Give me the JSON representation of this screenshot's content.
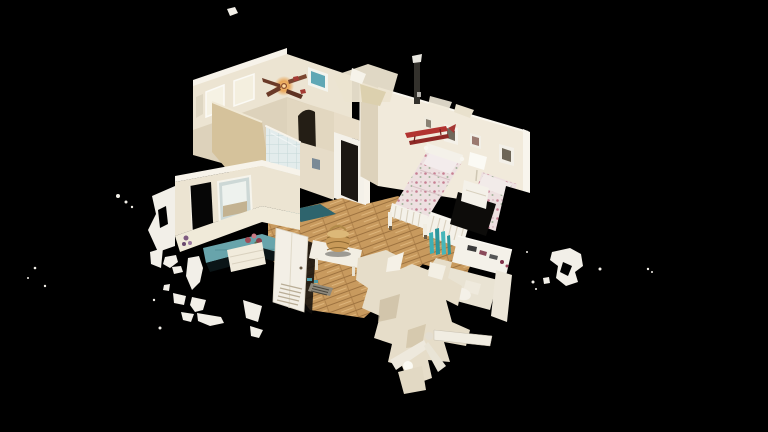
{
  "canvas": {
    "width": 768,
    "height": 432,
    "background": "#000000"
  },
  "scene": {
    "description": "Cutaway 3D dollhouse scan of a home interior floating on a black void: bedroom with two floral twin beds, oak-floored hallway, teal-floored parlor, tiled shower, vanity, ceiling fans and stray white scan fragments.",
    "view_mode": "dollhouse",
    "visible_text": "",
    "rooms": [
      {
        "name": "sitting-room",
        "objects": [
          "window-wall with two bright windows",
          "ceiling-fan with amber light",
          "teal wall art",
          "tan partition wall",
          "small tv"
        ]
      },
      {
        "name": "bedroom",
        "objects": [
          "twin-bed-1 floral",
          "twin-bed-2 floral",
          "nightstand",
          "table-lamp",
          "red biplane wall decor",
          "four picture frames",
          "oak floor"
        ]
      },
      {
        "name": "hallway",
        "objects": [
          "oak plank floor",
          "open louvered door",
          "wicker basket",
          "white bench",
          "floor vent",
          "dark teal runner rug",
          "tiled shower",
          "doorway to bedroom",
          "arched stair opening"
        ]
      },
      {
        "name": "parlor",
        "objects": [
          "dark open doorway",
          "bright mirror window",
          "teal painted floor",
          "flower vases",
          "white dresser"
        ]
      },
      {
        "name": "bathroom-vanity",
        "objects": [
          "teal bottles",
          "white vanity with toiletries",
          "toilet",
          "fixture column"
        ]
      },
      {
        "name": "lower-level-cutaway",
        "objects": [
          "below-floor ceiling fan",
          "light globe",
          "hanging scan fragments"
        ]
      }
    ]
  },
  "palette": {
    "bg": "#000000",
    "wall": "#ece4d2",
    "wallFace": "#f1eadb",
    "wallBright": "#f7f3ea",
    "wallShade": "#ddd2bb",
    "wallDark": "#cbbda0",
    "tan": "#d5c29b",
    "wood": "#c89a5e",
    "woodDark": "#9e7340",
    "woodLight": "#e6c088",
    "teal": "#68a4ab",
    "tealBright": "#3fafb4",
    "tealRug": "#2e646d",
    "tile": "#e3ecec",
    "tileLine": "#c6d8d8",
    "floralBase": "#ede0e0",
    "floralDot": "#c77f92",
    "bedWhite": "#f4f1e9",
    "red": "#b23330",
    "redDark": "#8f2926",
    "amber": "#e89b43",
    "amberGlow": "#f6c987",
    "artTeal": "#5fa7b5",
    "fragment": "#f2efe8",
    "shadow": "#0d0c0a"
  },
  "fragments": {
    "polygons": [
      {
        "points": "227,9 235,7 238,13 230,16"
      },
      {
        "points": "152,196 175,186 175,246 158,252 148,230 156,214"
      },
      {
        "points": "150,252 163,248 161,268 151,264"
      },
      {
        "points": "165,257 176,255 178,262 170,268 163,264"
      },
      {
        "points": "172,267 181,266 183,272 174,274"
      },
      {
        "points": "188,258 199,256 203,268 200,282 192,290 186,276"
      },
      {
        "points": "164,285 170,284 169,291 163,290"
      },
      {
        "points": "173,293 186,296 184,305 174,303"
      },
      {
        "points": "192,297 206,300 203,310 195,312 190,305"
      },
      {
        "points": "181,312 194,314 191,322 183,320"
      },
      {
        "points": "197,313 221,317 224,323 210,326 198,321"
      },
      {
        "points": "243,300 262,306 258,322 246,318"
      },
      {
        "points": "250,326 263,330 259,338 251,336"
      },
      {
        "points": "552,252 570,248 581,254 583,266 575,272 578,282 566,286 556,278 558,266 550,260"
      },
      {
        "points": "543,278 549,277 550,283 544,284"
      }
    ],
    "holes": [
      {
        "points": "158,210 166,206 168,224 160,228"
      },
      {
        "points": "563,262 572,266 568,276 560,272"
      }
    ],
    "dots": [
      [
        160,
        328,
        1.5
      ],
      [
        154,
        300,
        1.2
      ],
      [
        533,
        282,
        1.5
      ],
      [
        536,
        289,
        1
      ],
      [
        600,
        269,
        1.5
      ],
      [
        648,
        269,
        1.2
      ],
      [
        652,
        272,
        1
      ],
      [
        35,
        268,
        1.3
      ],
      [
        45,
        286,
        1.2
      ],
      [
        28,
        278,
        1
      ],
      [
        118,
        196,
        2
      ],
      [
        126,
        202,
        1.5
      ],
      [
        132,
        207,
        1.2
      ],
      [
        527,
        252,
        1
      ]
    ]
  }
}
